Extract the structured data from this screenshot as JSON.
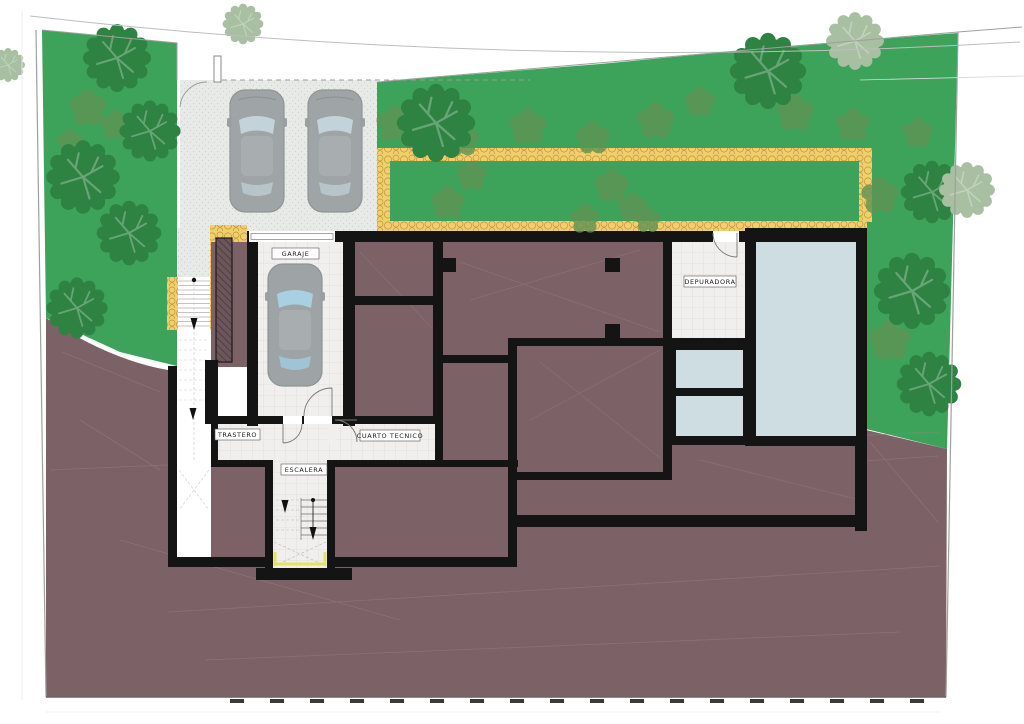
{
  "plan": {
    "rooms": {
      "garaje": "GARAJE",
      "trastero": "TRASTERO",
      "escalera": "ESCALERA",
      "cuarto_tecnico": "CUARTO TECNICO",
      "depuradora": "DEPURADORA"
    }
  },
  "colors": {
    "grass": "#3da35a",
    "grass_shrub": "#5f9355",
    "tree_dark": "#2e8242",
    "tree_pale": "#a8bfa2",
    "terrain": "#7c6266",
    "path": "#f2cf6b",
    "path_stone": "#bd9440",
    "pool": "#cedde1",
    "wall": "#141414",
    "driveway": "#e7eae6",
    "tile": "#f0efed"
  }
}
